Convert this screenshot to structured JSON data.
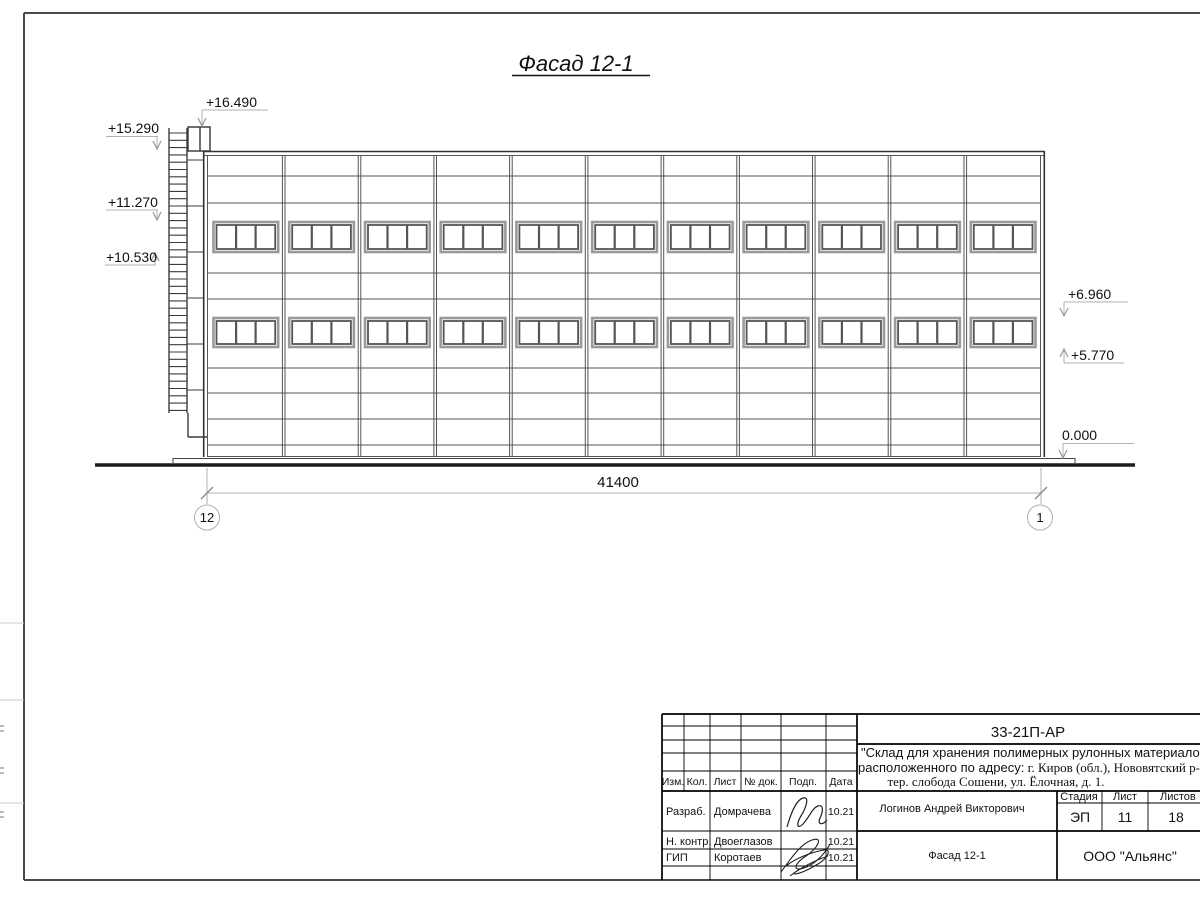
{
  "drawing": {
    "title": "Фасад 12-1",
    "total_dimension": "41400",
    "axes": [
      {
        "label": "12"
      },
      {
        "label": "1"
      }
    ],
    "elevation_marks": [
      {
        "label": "+16.490"
      },
      {
        "label": "+15.290"
      },
      {
        "label": "+11.270"
      },
      {
        "label": "+10.530"
      },
      {
        "label": "+6.960"
      },
      {
        "label": "+5.770"
      },
      {
        "label": "0.000"
      }
    ]
  },
  "title_block": {
    "doc_number": "33-21П-АР",
    "project_line1": "\"Склад для хранения полимерных рулонных материалов",
    "project_line2_sans": "расположенного по адресу:",
    "project_line2_serif": " г. Киров (обл.), Нововятский р-н,",
    "project_line3": "тер. слобода Сошени, ул. Ёлочная, д. 1.",
    "rev_header": {
      "izm": "Изм.",
      "kol": "Кол.",
      "list": "Лист",
      "ndok": "№ док.",
      "podp": "Подп.",
      "data": "Дата"
    },
    "roles": [
      {
        "role": "Разраб.",
        "name": "Домрачева",
        "date": "10.21"
      },
      {
        "role": "Н. контр.",
        "name": "Двоеглазов",
        "date": "10.21"
      },
      {
        "role": "ГИП",
        "name": "Коротаев",
        "date": "10.21"
      }
    ],
    "stage_header": {
      "stage": "Стадия",
      "sheet": "Лист",
      "sheets": "Листов"
    },
    "stage_value": "ЭП",
    "sheet_value": "11",
    "sheets_value": "18",
    "chief": "Логинов Андрей Викторович",
    "sheet_title": "Фасад 12-1",
    "company": "ООО \"Альянс\""
  },
  "colors": {
    "building_line": "#444444",
    "dim_line": "#b0b0b0",
    "arrow": "#999999",
    "block_line": "#000000"
  }
}
